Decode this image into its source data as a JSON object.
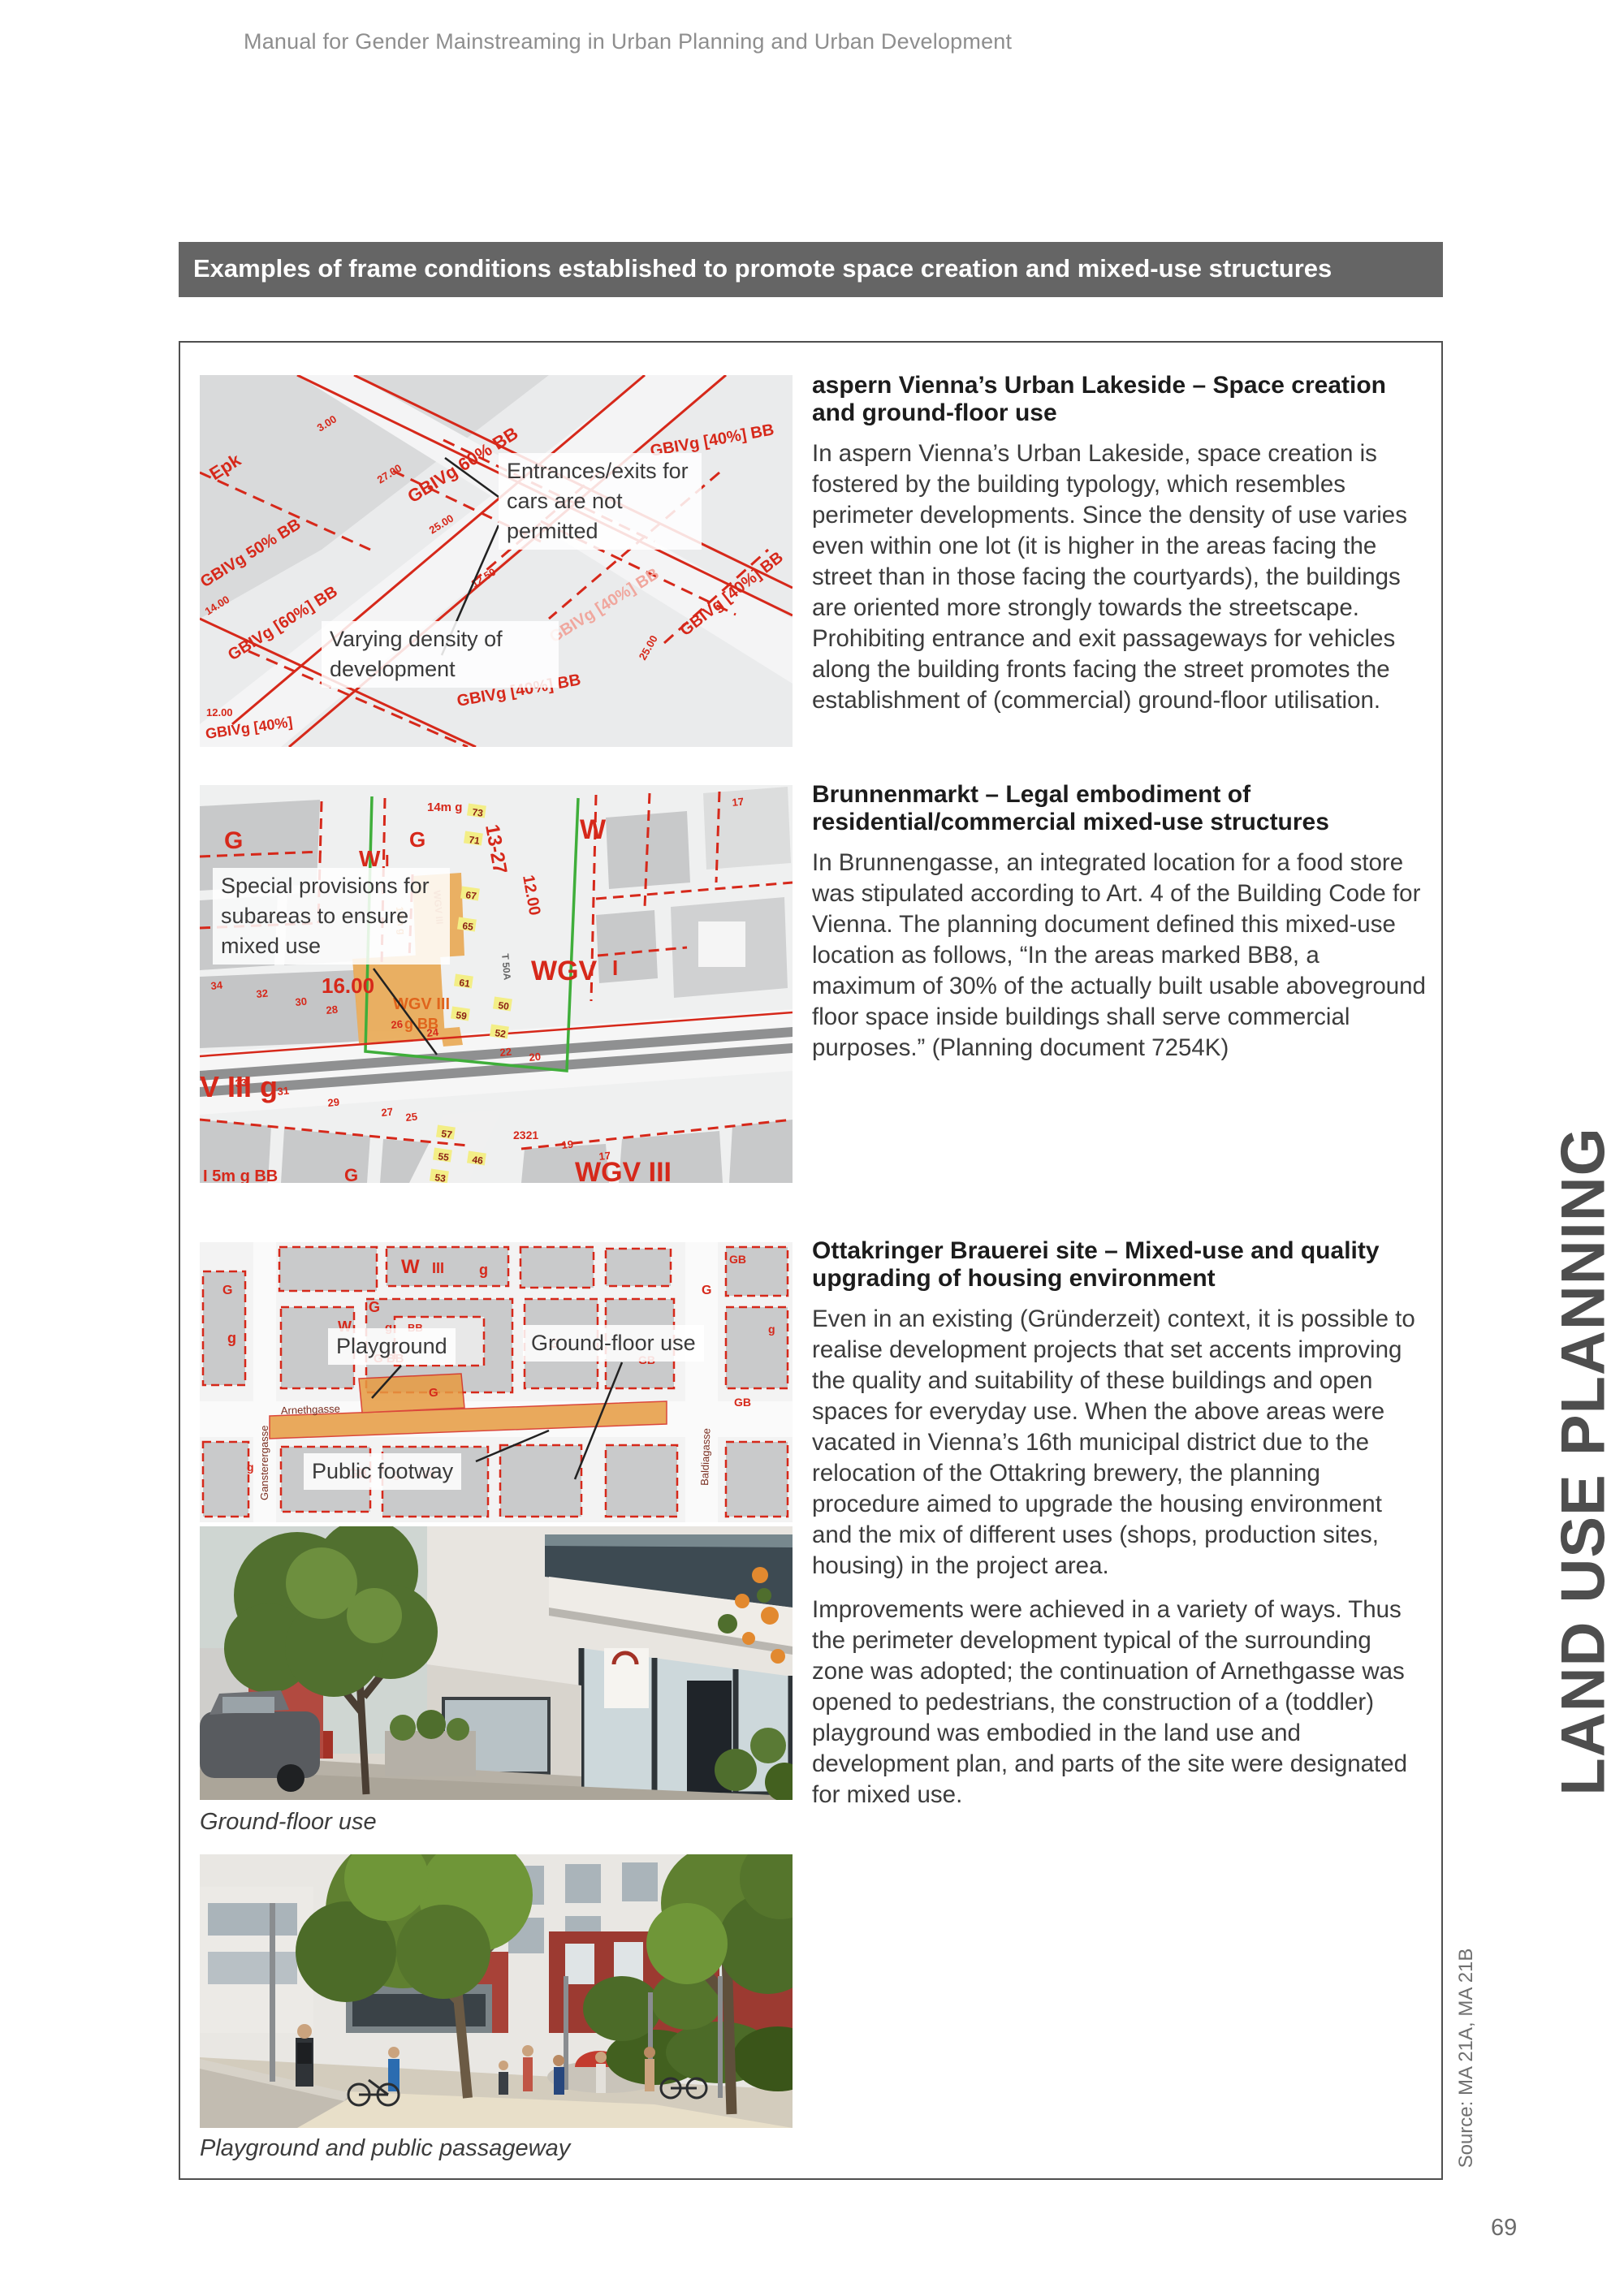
{
  "page": {
    "header": "Manual for Gender Mainstreaming in Urban Planning and Urban Development",
    "page_number": "69"
  },
  "side": {
    "label": "LAND USE PLANNING",
    "source": "Source: MA 21A, MA 21B"
  },
  "banner": {
    "title": "Examples of frame conditions established to promote space creation and mixed-use structures",
    "bg_color": "#656565",
    "text_color": "#ffffff"
  },
  "sections": {
    "aspern": {
      "heading": "aspern Vienna’s Urban Lakeside – Space creation and ground-floor use",
      "body": "In aspern Vienna’s Urban Lakeside, space creation is fostered by the building typology, which resembles perimeter developments. Since the density of use varies even within one lot (it is higher in the areas facing the street than in those facing the courtyards), the buildings are oriented more strongly towards the streetscape. Prohibiting entrance and exit passageways for vehicles along the building fronts facing the street promotes the establishment of (commercial) ground-floor utilisation."
    },
    "brunnenmarkt": {
      "heading": "Brunnenmarkt – Legal embodiment of residential/commercial mixed-use structures",
      "body": "In Brunnengasse, an integrated location for a food store was stipulated according to Art. 4 of the Building Code for Vienna. The planning document defined this mixed-use location as follows, “In the areas marked BB8, a maximum of 30% of the actually built usable aboveground floor space inside buildings shall serve commercial purposes.” (Planning document 7254K)"
    },
    "ottakringer": {
      "heading": "Ottakringer Brauerei site – Mixed-use and quality upgrading of housing environment",
      "body1": "Even in an existing (Gründerzeit) context, it is possible to realise development projects that set accents improving the quality and suitability of these buildings and open spaces for everyday use. When the above areas were vacated in Vienna’s 16th municipal district due to the relocation of the Ottakring brewery, the planning procedure aimed to upgrade the housing environment and the mix of different uses (shops, production sites, housing) in the project area.",
      "body2": "Improvements were achieved in a variety of ways. Thus the perimeter development typical of the surrounding zone was adopted; the continuation of Arnethgasse was opened to pedestrians, the construction of a (toddler) playground was embodied in the land use and development plan, and parts of the site were designated for mixed use."
    }
  },
  "captions": {
    "photo1": "Ground-floor use",
    "photo2": "Playground and public passageway"
  },
  "map_aspern": {
    "label_density": "Varying density of development",
    "label_entrances": "Entrances/exits for cars are not permitted",
    "codes": [
      "Epk",
      "GBIVg 50% BB",
      "GBIVg 60% BB",
      "GBIVg [40%] BB",
      "GBIVg [60%] BB",
      "GBIVg [40%]"
    ],
    "dims": [
      "3.00",
      "27.00",
      "25.00",
      "14.00",
      "12.00",
      "12.50"
    ]
  },
  "map_brunnenmarkt": {
    "label_special": "Special provisions for subareas to ensure mixed use",
    "codes": [
      "G",
      "W",
      "I",
      "14m g",
      "13-27",
      "12.00",
      "16.00",
      "WGV",
      "WGV III",
      "g BB",
      "V III g",
      "I 5m g BB",
      "2321",
      "T 50A",
      "WGV III"
    ],
    "house_numbers": [
      "34",
      "32",
      "30",
      "28",
      "26",
      "24",
      "22",
      "20",
      "33",
      "31",
      "29",
      "27",
      "25",
      "19",
      "17"
    ],
    "street_numbers": [
      "73",
      "71",
      "67",
      "65",
      "61",
      "59",
      "57",
      "55",
      "53",
      "51",
      "50",
      "52",
      "46",
      "44"
    ]
  },
  "map_ottakringer": {
    "label_playground": "Playground",
    "label_groundfloor": "Ground-floor use",
    "label_footway": "Public footway",
    "streets": [
      "Arnethgasse",
      "Gansterergasse",
      "Baldiagasse"
    ],
    "codes": [
      "W",
      "III",
      "g",
      "G",
      "GB",
      "BB",
      "G BB"
    ]
  },
  "colors": {
    "map_red": "#d6281a",
    "highlight_orange": "#e9a44a",
    "boundary_green": "#3fae3a"
  }
}
